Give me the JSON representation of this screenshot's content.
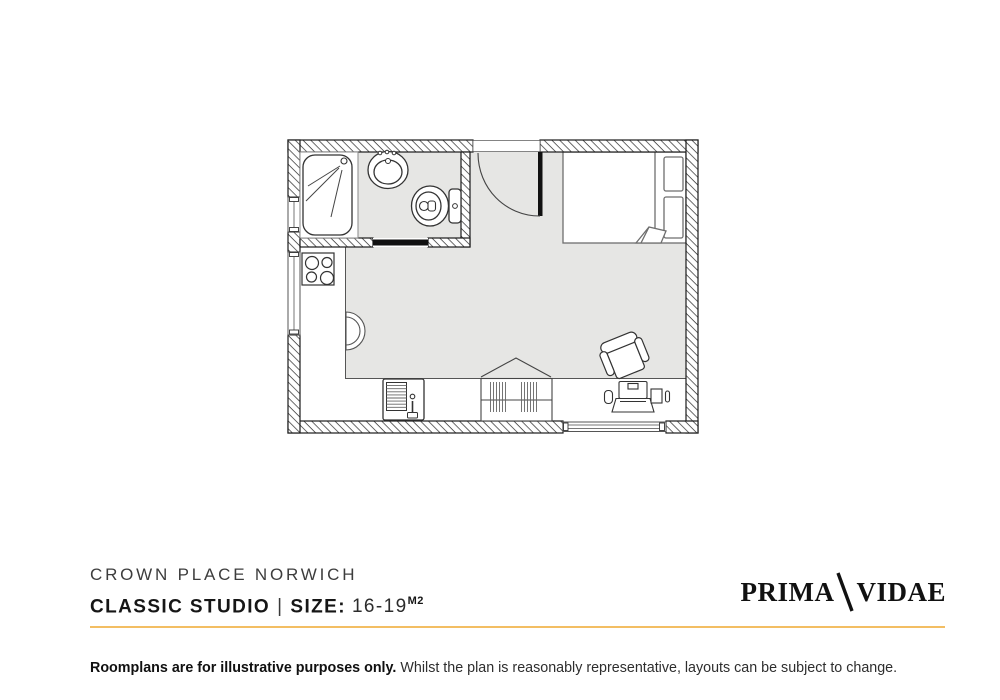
{
  "plan": {
    "title": "Classic studio floorplan",
    "rooms": [
      "bathroom",
      "kitchen",
      "living-sleeping-area"
    ],
    "fixtures": [
      "shower",
      "washbasin",
      "toilet",
      "sliding-bathroom-door",
      "entrance-door",
      "double-bed",
      "hob",
      "counter-bowl",
      "kitchen-sink",
      "wardrobe",
      "desk",
      "laptop",
      "desk-chair",
      "window-left-upper",
      "window-left-lower",
      "window-bottom"
    ]
  },
  "footer": {
    "property_name": "CROWN PLACE NORWICH",
    "room_type": "CLASSIC STUDIO",
    "separator": "|",
    "size_label": "SIZE:",
    "size_value": "16-19",
    "size_unit": "M2",
    "brand": {
      "part1": "PRIMA",
      "part2": "VIDAE"
    },
    "disclaimer_bold": "Roomplans are for illustrative purposes only.",
    "disclaimer_regular": "Whilst the plan is reasonably representative, layouts can be subject to change."
  },
  "colors": {
    "accent_gold": "#F3BE63",
    "floor_grey": "#E6E6E4",
    "wall_ink": "#1c1c1c",
    "title_grey": "#3d3d3d",
    "text_dark": "#161616"
  }
}
